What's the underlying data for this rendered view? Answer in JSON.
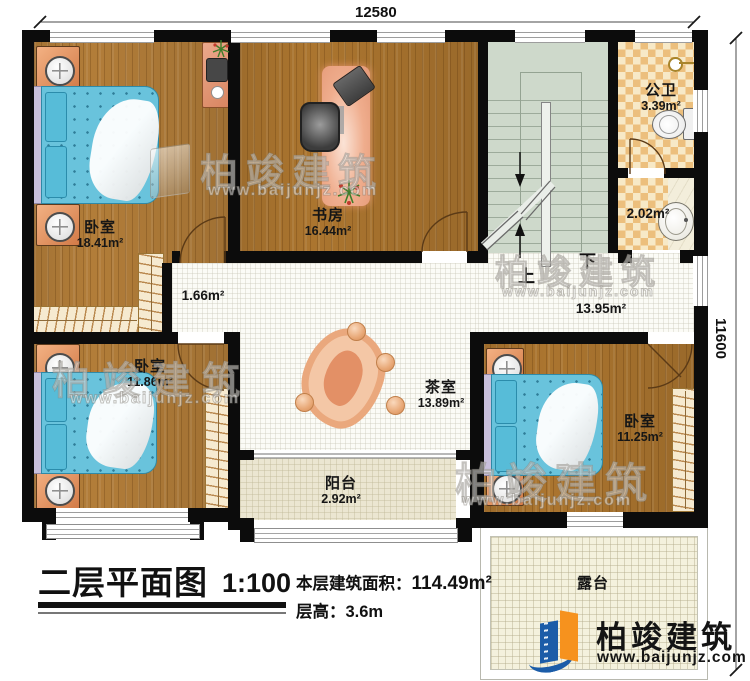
{
  "dimensions": {
    "top": "12580",
    "right": "11600"
  },
  "rooms": {
    "bedroom_tl": {
      "name": "卧室",
      "area": "18.41m²"
    },
    "study": {
      "name": "书房",
      "area": "16.44m²"
    },
    "public_bath": {
      "name": "公卫",
      "area": "3.39m²"
    },
    "wash_area": {
      "area": "2.02m²"
    },
    "corridor": {
      "area": "1.66m²"
    },
    "hallway": {
      "area": "13.95m²"
    },
    "tea_room": {
      "name": "茶室",
      "area": "13.89m²"
    },
    "bedroom_bl": {
      "name": "卧室",
      "area": "11.86m²"
    },
    "bedroom_br": {
      "name": "卧室",
      "area": "11.25m²"
    },
    "balcony": {
      "name": "阳台",
      "area": "2.92m²"
    },
    "terrace": {
      "name": "露台"
    }
  },
  "stairs": {
    "up_label": "上",
    "down_label": "下"
  },
  "title_block": {
    "title": "二层平面图",
    "scale": "1:100",
    "area_label": "本层建筑面积：",
    "area_value": "114.49m²",
    "floor_height_label": "层高：3.6m"
  },
  "brand": {
    "name": "柏竣建筑",
    "website": "www.baijunjz.com"
  }
}
